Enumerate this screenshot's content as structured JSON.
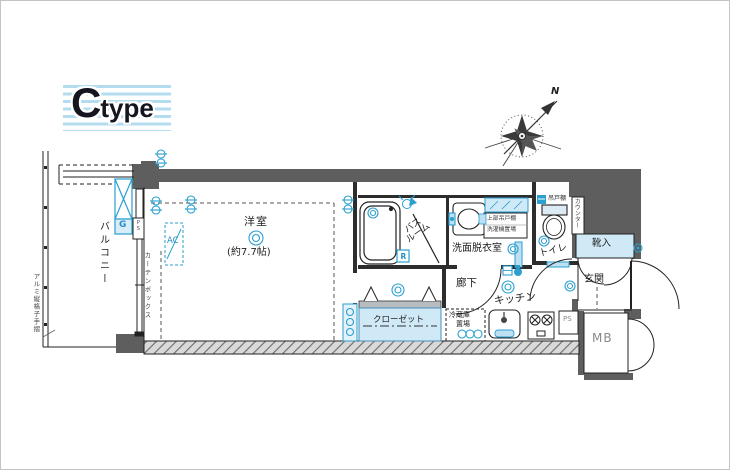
{
  "logo": {
    "c": "C",
    "type": "type"
  },
  "compass": {
    "north": "N"
  },
  "rooms": {
    "main": "洋室",
    "main_size": "(約7.7帖)",
    "balcony": "バルコニー",
    "bath_line1": "バス",
    "bath_line2": "ルーム",
    "washroom": "洗面脱衣室",
    "toilet": "トイレ",
    "entrance": "玄関",
    "corridor": "廊下",
    "kitchen": "キッチン",
    "closet": "クローゼット",
    "fridge_line1": "冷蔵庫",
    "fridge_line2": "置場",
    "shoe_box": "靴入",
    "meter_box": "MB"
  },
  "labels": {
    "ps": "PS",
    "gas_meter": "G",
    "air_con": "AC",
    "reheating": "R",
    "curtain_box": "カーテンボックス",
    "handrail": "アルミ縦格子手摺",
    "counter": "カウンター",
    "hanging_cupboard": "吊戸棚",
    "washer_line1": "上部吊戸棚",
    "washer_line2": "洗濯機置場"
  },
  "colors": {
    "wall": "#5e5e5e",
    "accent": "#2a9fd0",
    "light_blue": "#cfe9f6",
    "stripe": "#b3dcee"
  }
}
